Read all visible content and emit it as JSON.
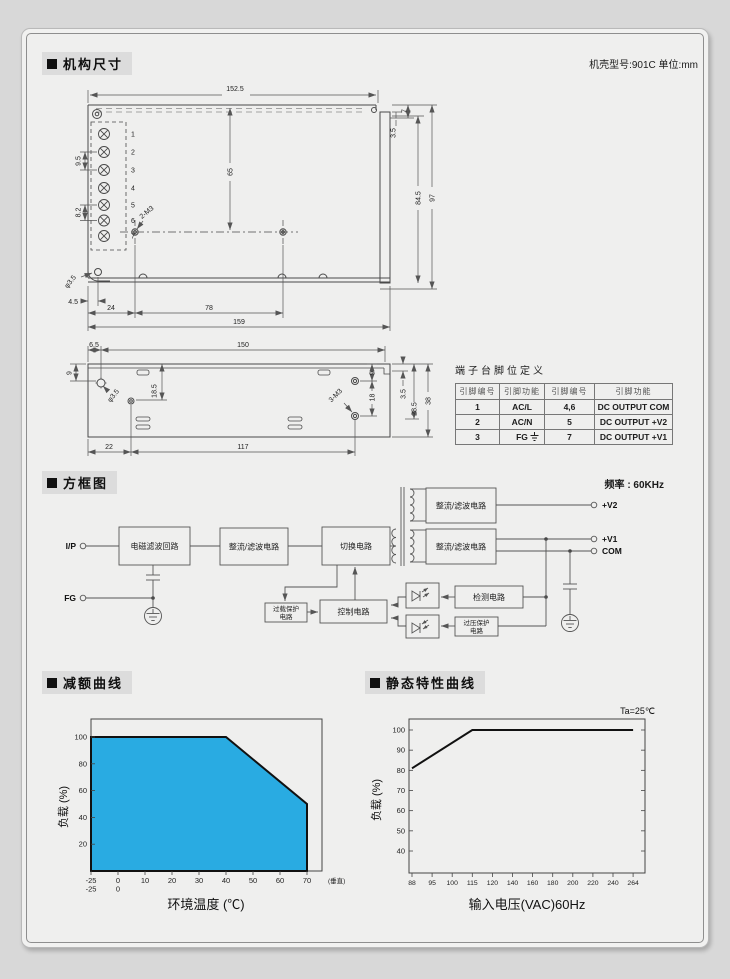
{
  "page": {
    "sections": {
      "mech": {
        "title": "机构尺寸",
        "note": "机壳型号:901C 单位:mm"
      },
      "block": {
        "title": "方框图",
        "note": "频率 : 60KHz"
      },
      "derating": {
        "title": "减额曲线"
      },
      "static_curve": {
        "title": "静态特性曲线"
      }
    }
  },
  "mech": {
    "top_view": {
      "dim_152_5": "152.5",
      "dim_65": "65",
      "dim_9_5": "9.5",
      "dim_8_2": "8.2",
      "label_2m3": "2-M3",
      "dim_7": "7",
      "dim_3_5": "3.5",
      "dim_84_5": "84.5",
      "dim_97": "97",
      "label_dia": "φ3.5",
      "dim_4_5": "4.5",
      "dim_24": "24",
      "dim_78": "78",
      "dim_159": "159",
      "terminals": [
        "1",
        "2",
        "3",
        "4",
        "5",
        "6",
        "7"
      ]
    },
    "side_view": {
      "dim_6_5": "6.5",
      "dim_150": "150",
      "dim_9_left": "9",
      "label_dia": "φ3.5",
      "dim_18_5": "18.5",
      "label_3m3": "3-M3",
      "dim_9_right": "9",
      "dim_18": "18",
      "dim_3_5": "3.5",
      "dim_28_5": "28.5",
      "dim_38": "38",
      "dim_22": "22",
      "dim_117": "117"
    },
    "terminal_table": {
      "title": "端子台脚位定义",
      "headers": [
        "引脚编号",
        "引脚功能",
        "引脚编号",
        "引脚功能"
      ],
      "rows": [
        [
          "1",
          "AC/L",
          "4,6",
          "DC OUTPUT COM"
        ],
        [
          "2",
          "AC/N",
          "5",
          "DC OUTPUT +V2"
        ],
        [
          "3",
          "FG",
          "7",
          "DC OUTPUT +V1"
        ]
      ]
    }
  },
  "block_diagram": {
    "input_label": "I/P",
    "fg_label": "FG",
    "emi_filter": "电磁滤波回路",
    "rectifier_input": "整流/滤波电路",
    "switching": "切换电路",
    "rectifier_v2": "整流/滤波电路",
    "rectifier_v1": "整流/滤波电路",
    "overload": {
      "line1": "过载保护",
      "line2": "电路"
    },
    "control": "控制电路",
    "detection": "检测电路",
    "overvoltage": {
      "line1": "过压保护",
      "line2": "电路"
    },
    "out_v2": "+V2",
    "out_v1": "+V1",
    "out_com": "COM"
  },
  "chart_data": [
    {
      "type": "area",
      "title": "减额曲线",
      "xlabel": "环境温度 (℃)",
      "ylabel": "负载 (%)",
      "x_ticks": [
        -25,
        0,
        10,
        20,
        30,
        40,
        50,
        60,
        70
      ],
      "x_ticks_row2": [
        "-25",
        "0"
      ],
      "x_note": "(垂直)",
      "y_ticks": [
        20,
        40,
        60,
        80,
        100
      ],
      "xlim": [
        -25,
        75
      ],
      "ylim": [
        0,
        110
      ],
      "grid": false,
      "points": [
        [
          -25,
          100
        ],
        [
          40,
          100
        ],
        [
          70,
          50
        ],
        [
          70,
          0
        ],
        [
          -25,
          0
        ]
      ],
      "fill_color": "#29abe2",
      "line_color": "#111111"
    },
    {
      "type": "line",
      "title": "静态特性曲线",
      "annotation": "Ta=25℃",
      "xlabel": "输入电压(VAC)60Hz",
      "ylabel": "负载 (%)",
      "x_ticks": [
        88,
        95,
        100,
        115,
        120,
        140,
        160,
        180,
        200,
        220,
        240,
        264
      ],
      "y_ticks": [
        40,
        50,
        60,
        70,
        80,
        90,
        100
      ],
      "xlim": [
        88,
        264
      ],
      "ylim": [
        35,
        105
      ],
      "grid": false,
      "points": [
        [
          88,
          81
        ],
        [
          115,
          100
        ],
        [
          264,
          100
        ]
      ],
      "line_color": "#111111"
    }
  ]
}
